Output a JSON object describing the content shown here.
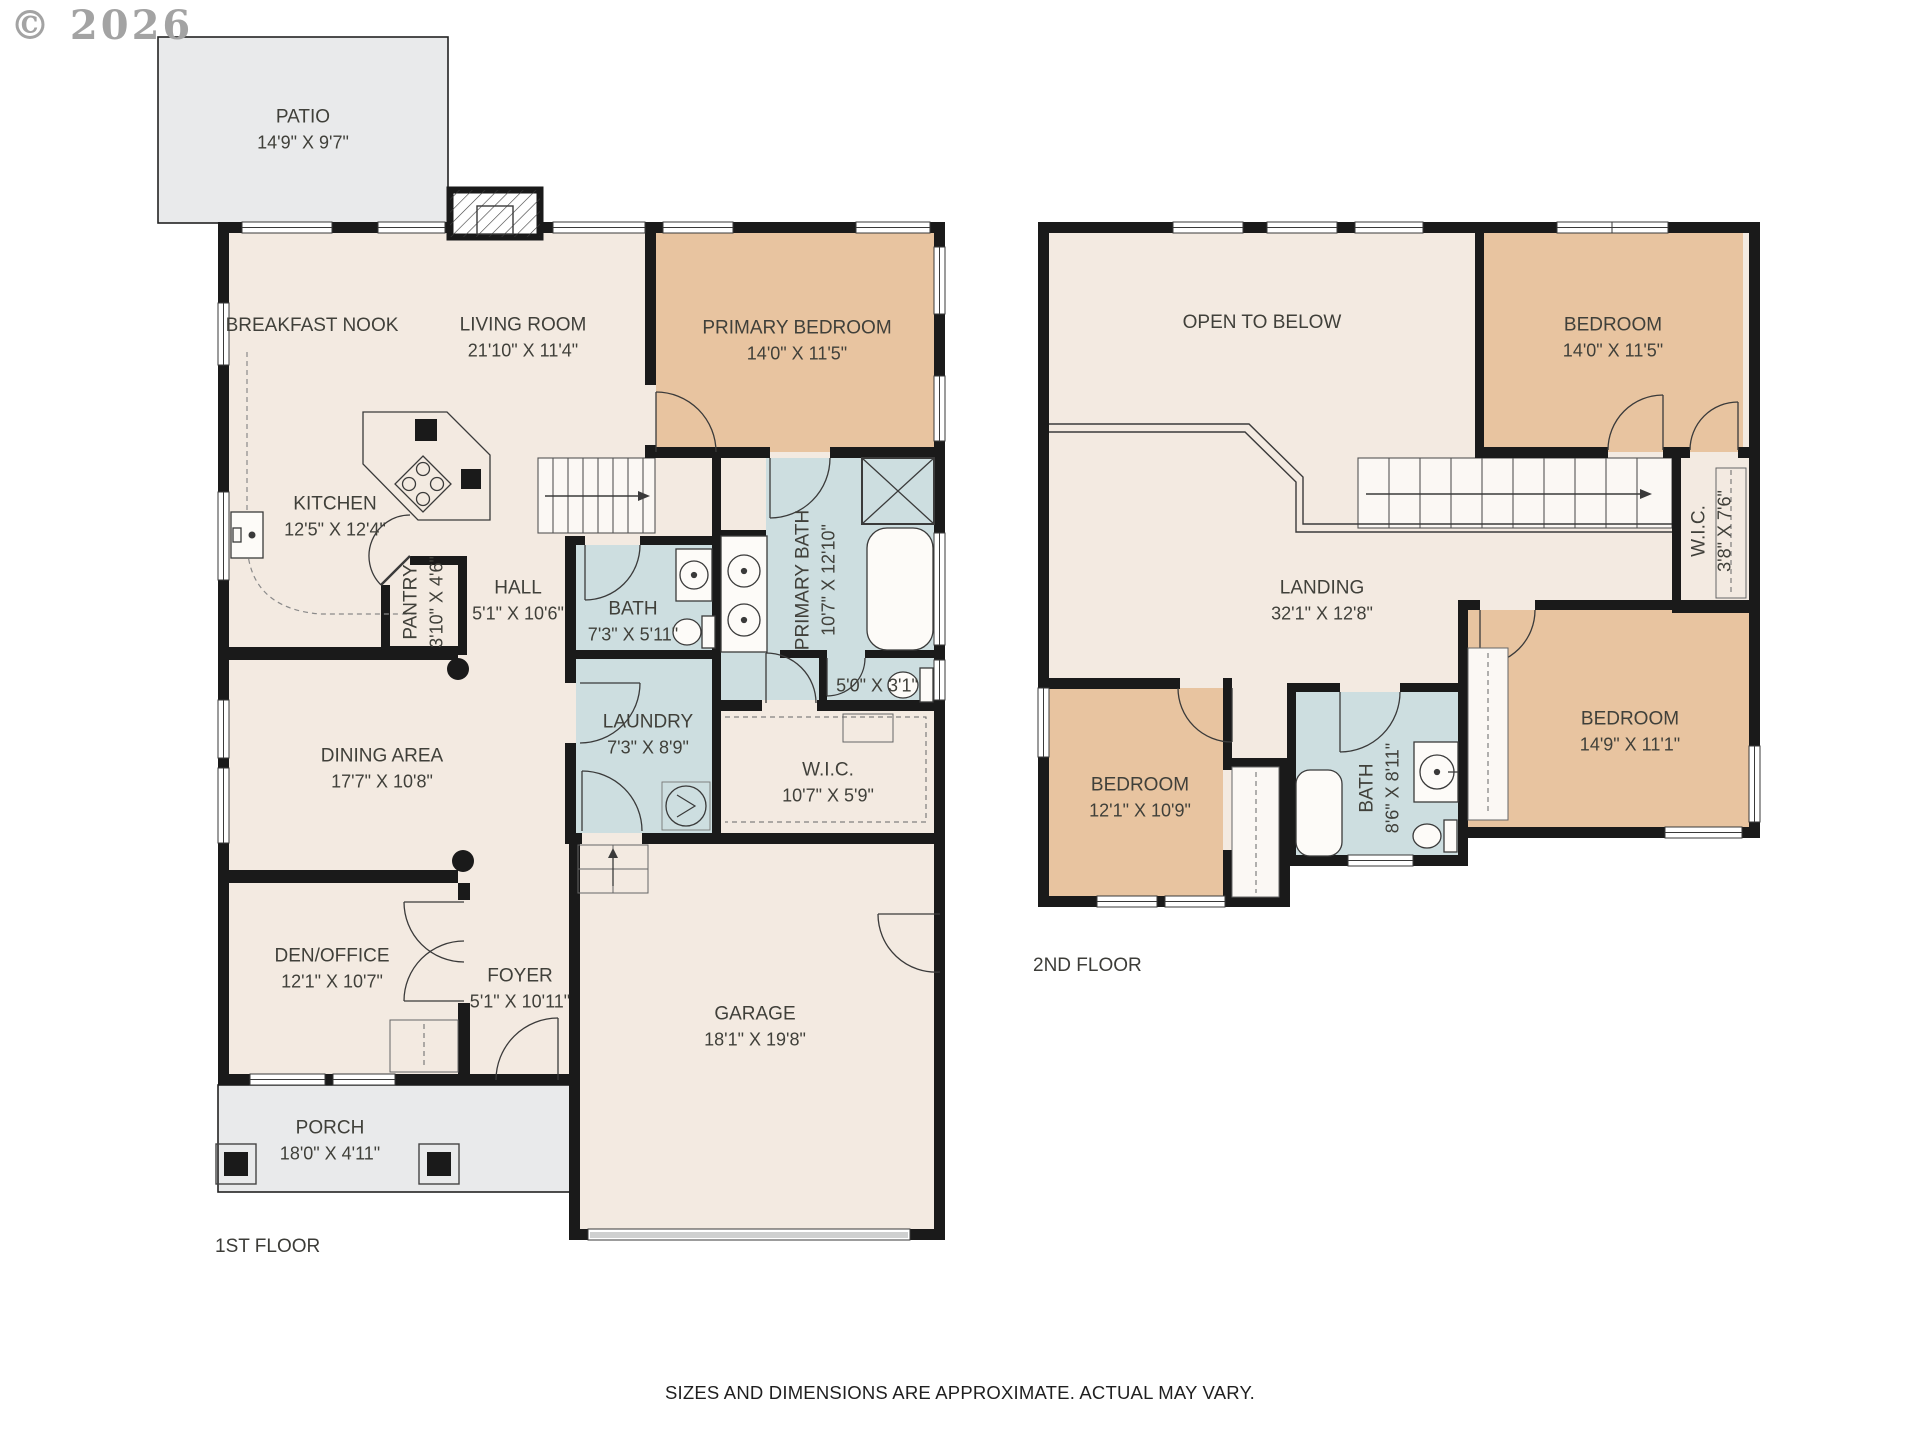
{
  "copyright": "© 2026",
  "disclaimer": "SIZES AND DIMENSIONS ARE APPROXIMATE. ACTUAL MAY VARY.",
  "colors": {
    "floor": "#f3eae1",
    "bedroom": "#e8c4a0",
    "bath": "#cddee0",
    "outdoor": "#e9eaeb",
    "wall": "#1a1a1a"
  },
  "floor1": {
    "label": "1ST FLOOR",
    "rooms": [
      {
        "name": "PATIO",
        "dims": "14'9\" X 9'7\""
      },
      {
        "name": "BREAKFAST NOOK",
        "dims": ""
      },
      {
        "name": "LIVING ROOM",
        "dims": "21'10\" X 11'4\""
      },
      {
        "name": "PRIMARY BEDROOM",
        "dims": "14'0\" X 11'5\""
      },
      {
        "name": "KITCHEN",
        "dims": "12'5\" X 12'4\""
      },
      {
        "name": "PANTRY",
        "dims": "3'10\" X 4'6\""
      },
      {
        "name": "HALL",
        "dims": "5'1\" X 10'6\""
      },
      {
        "name": "BATH",
        "dims": "7'3\" X 5'11\""
      },
      {
        "name": "PRIMARY BATH",
        "dims": "10'7\" X 12'10\""
      },
      {
        "name": "",
        "dims": "5'0\" X 3'1\""
      },
      {
        "name": "LAUNDRY",
        "dims": "7'3\" X 8'9\""
      },
      {
        "name": "W.I.C.",
        "dims": "10'7\" X 5'9\""
      },
      {
        "name": "DINING AREA",
        "dims": "17'7\" X 10'8\""
      },
      {
        "name": "DEN/OFFICE",
        "dims": "12'1\" X 10'7\""
      },
      {
        "name": "FOYER",
        "dims": "5'1\" X 10'11\""
      },
      {
        "name": "GARAGE",
        "dims": "18'1\" X 19'8\""
      },
      {
        "name": "PORCH",
        "dims": "18'0\" X 4'11\""
      }
    ]
  },
  "floor2": {
    "label": "2ND FLOOR",
    "rooms": [
      {
        "name": "OPEN TO BELOW",
        "dims": ""
      },
      {
        "name": "BEDROOM",
        "dims": "14'0\" X 11'5\""
      },
      {
        "name": "W.I.C.",
        "dims": "3'8\" X 7'6\""
      },
      {
        "name": "LANDING",
        "dims": "32'1\" X 12'8\""
      },
      {
        "name": "BEDROOM",
        "dims": "12'1\" X 10'9\""
      },
      {
        "name": "BATH",
        "dims": "8'6\" X 8'11\""
      },
      {
        "name": "BEDROOM",
        "dims": "14'9\" X 11'1\""
      }
    ]
  }
}
